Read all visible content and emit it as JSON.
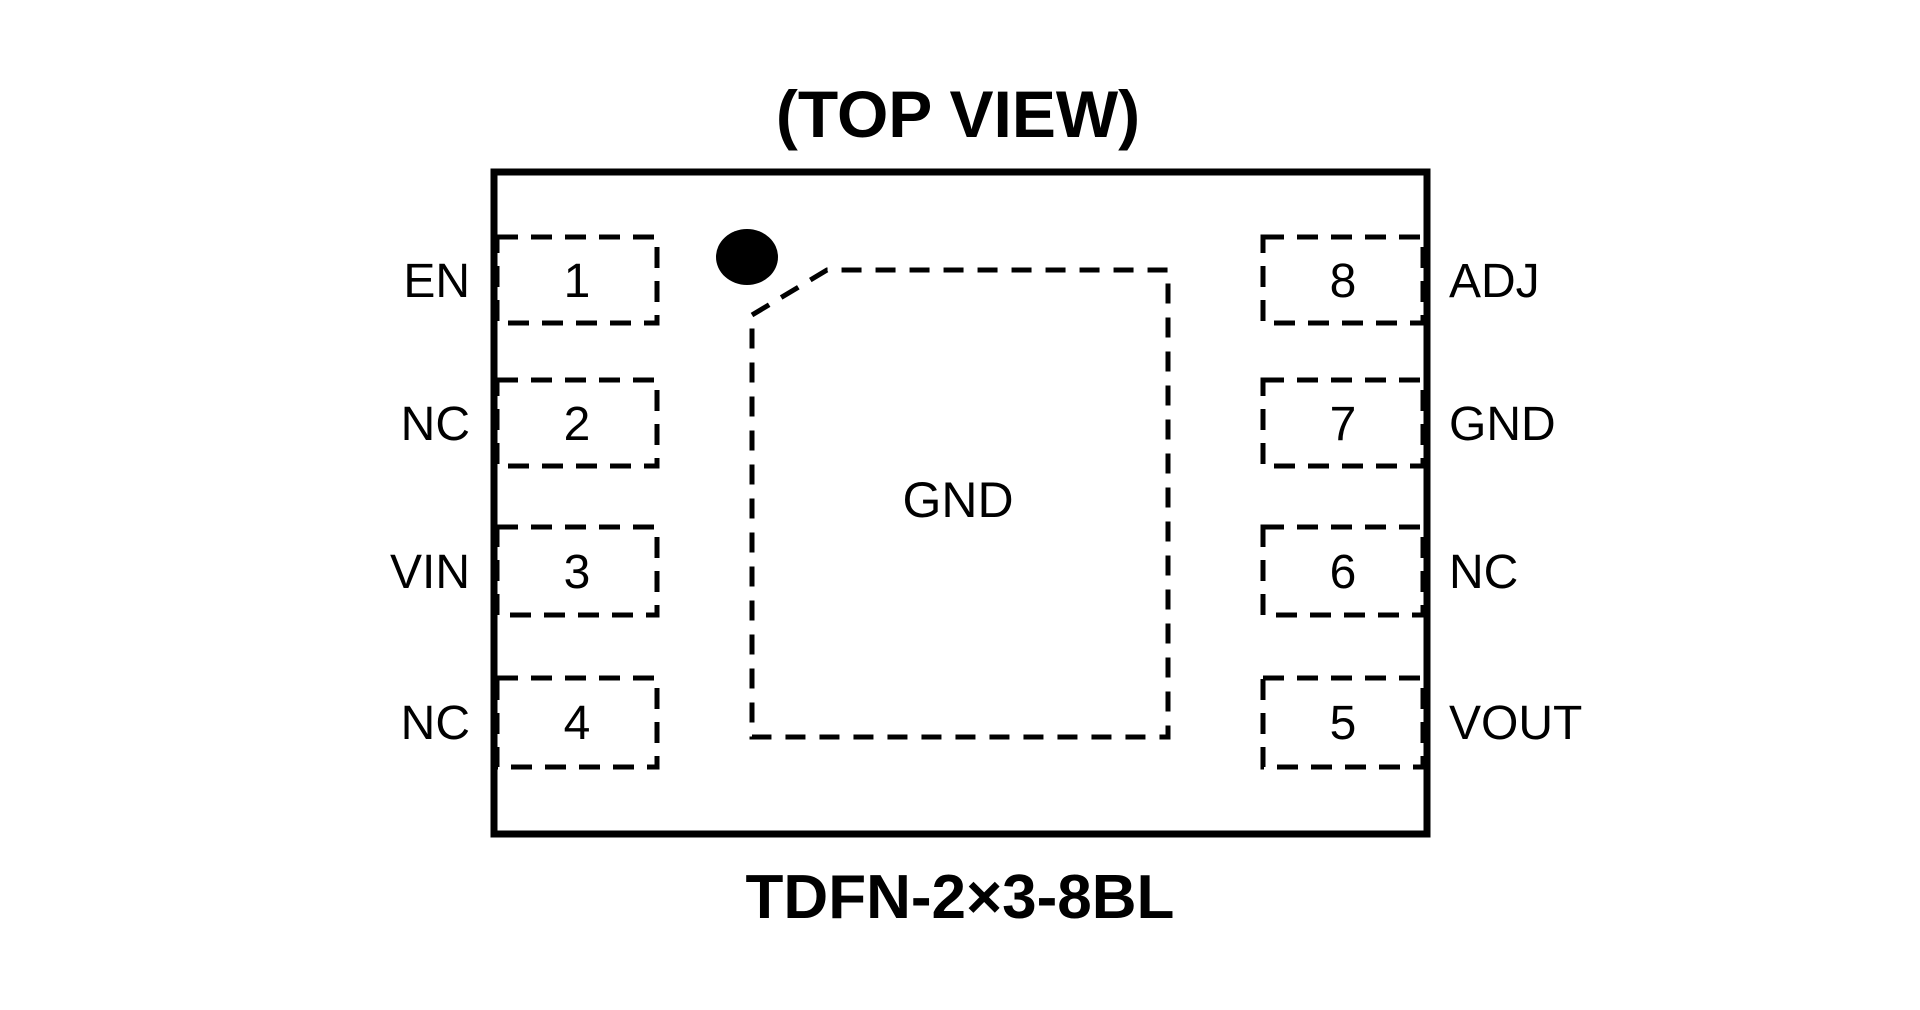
{
  "title": "(TOP VIEW)",
  "caption": "TDFN-2×3-8BL",
  "exposed_pad": {
    "label": "GND"
  },
  "pins": {
    "left": [
      {
        "number": "1",
        "label": "EN"
      },
      {
        "number": "2",
        "label": "NC"
      },
      {
        "number": "3",
        "label": "VIN"
      },
      {
        "number": "4",
        "label": "NC"
      }
    ],
    "right": [
      {
        "number": "8",
        "label": "ADJ"
      },
      {
        "number": "7",
        "label": "GND"
      },
      {
        "number": "6",
        "label": "NC"
      },
      {
        "number": "5",
        "label": "VOUT"
      }
    ]
  },
  "colors": {
    "line": "#000000",
    "background": "#ffffff"
  }
}
